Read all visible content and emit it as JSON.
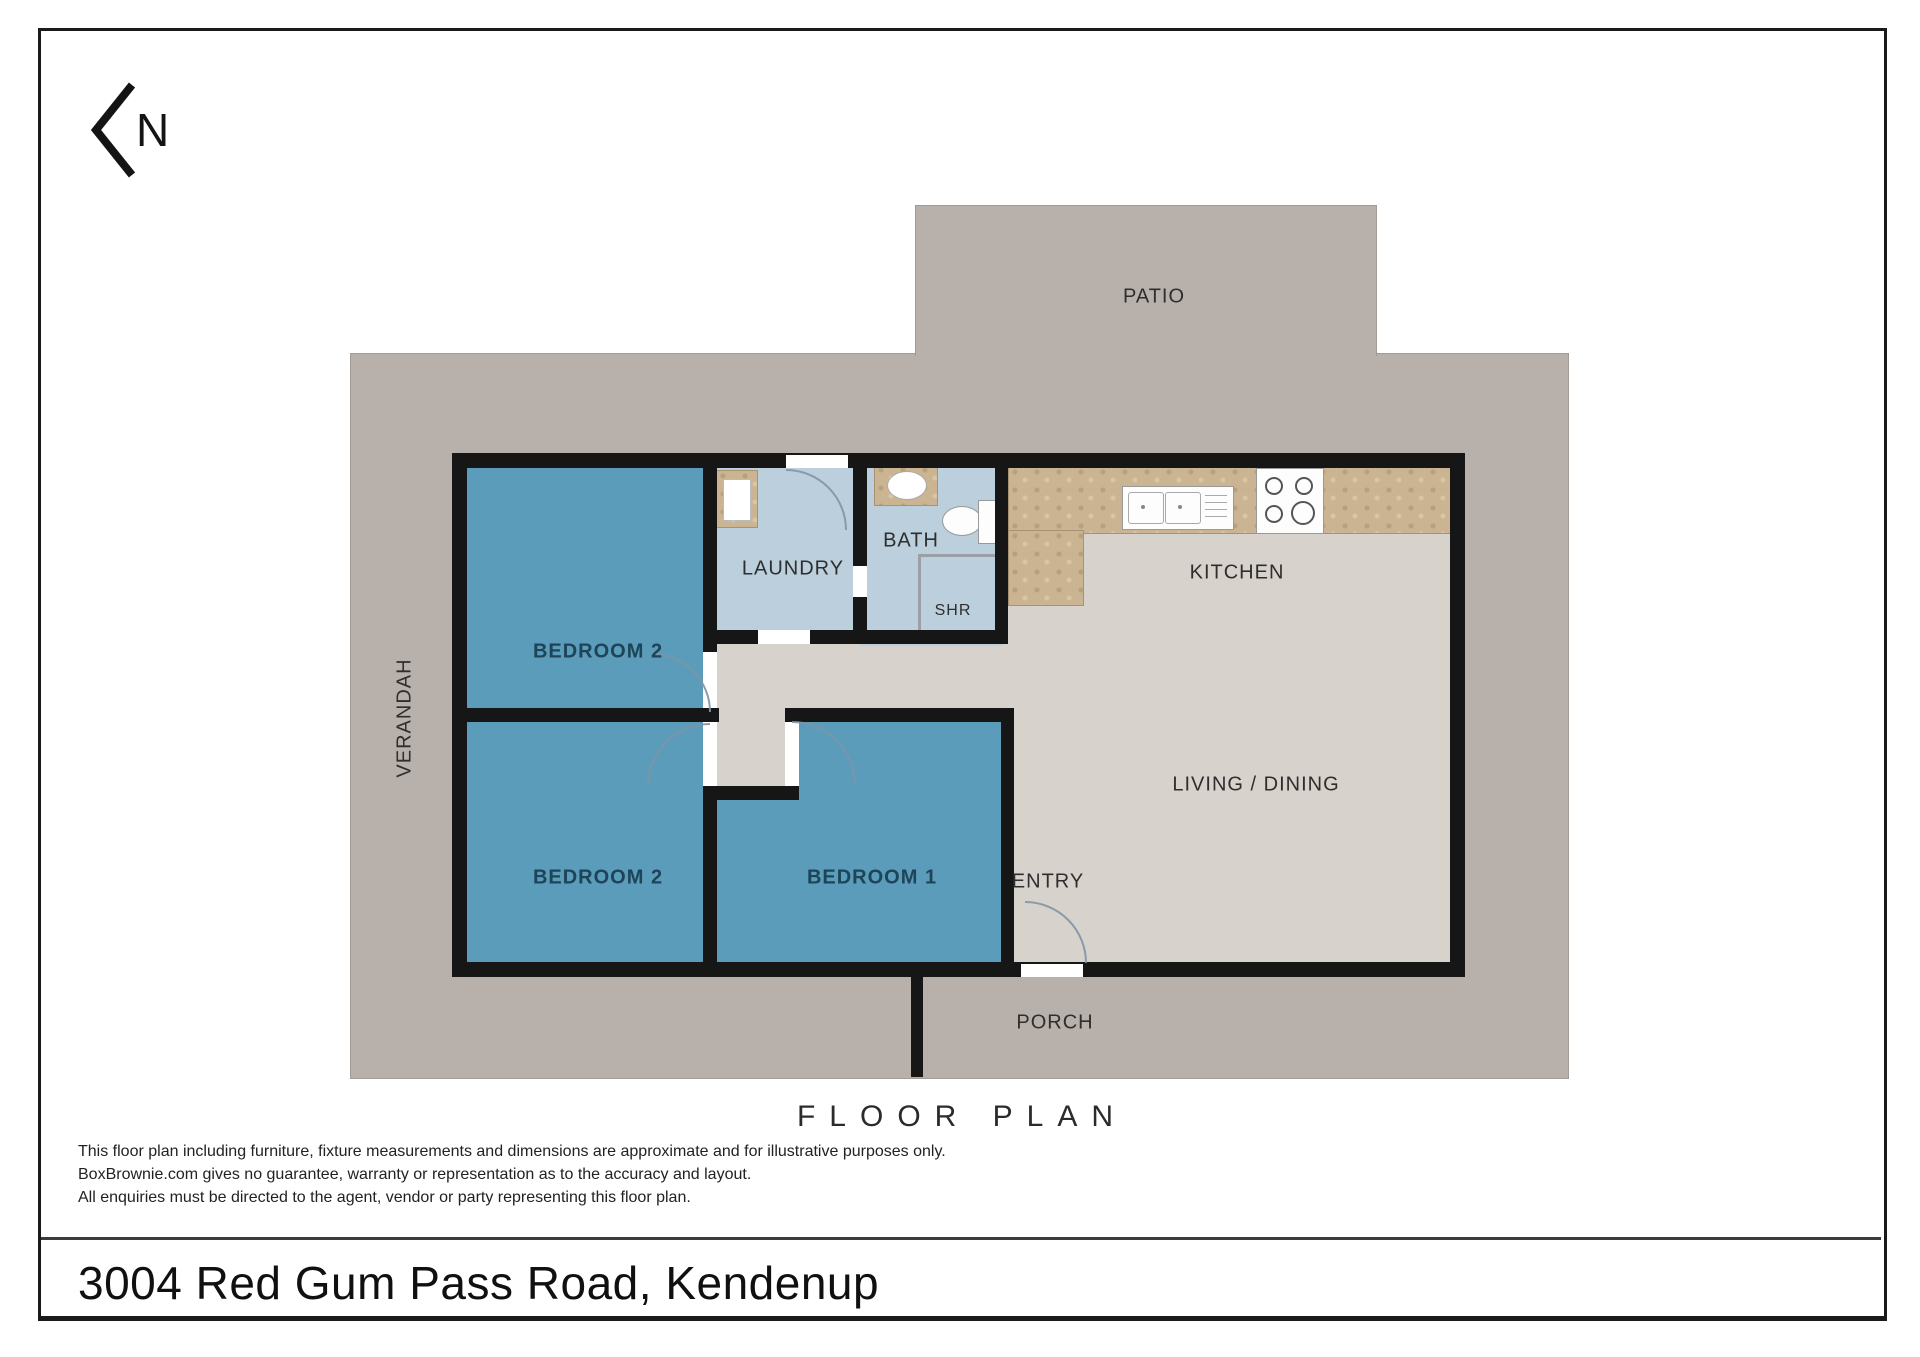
{
  "page": {
    "title": "FLOOR PLAN",
    "address": "3004 Red Gum Pass Road, Kendenup",
    "disclaimer": [
      "This floor plan including furniture, fixture measurements and dimensions are approximate and for illustrative purposes only.",
      "BoxBrownie.com gives no guarantee, warranty or representation as to the accuracy and layout.",
      "All enquiries must be directed to the agent, vendor or party representing this floor plan."
    ]
  },
  "compass": {
    "letter": "N"
  },
  "areas": {
    "patio": "PATIO",
    "verandah": "VERANDAH",
    "porch": "PORCH",
    "entry": "ENTRY"
  },
  "rooms": {
    "bedroom2_upper": "BEDROOM 2",
    "bedroom2_lower": "BEDROOM 2",
    "bedroom1": "BEDROOM 1",
    "laundry": "LAUNDRY",
    "bath": "BATH",
    "shower": "SHR",
    "kitchen": "KITCHEN",
    "living_dining": "LIVING / DINING"
  },
  "colors": {
    "slab": "#b7b0ab",
    "floor": "#d8d2cc",
    "bedroom": "#5b9cba",
    "wet_area": "#bccfdd",
    "counter": "#cbb492",
    "wall": "#161616",
    "bedroom_label": "#1d4458",
    "label": "#2e2e2e",
    "door_arc": "#7e95a6"
  },
  "icons": {
    "north_arrow": "chevron-left-with-N",
    "washing_machine": "top-view-appliance-square",
    "kitchen_sink": "double-bowl-sink-with-drainer",
    "cooktop": "four-burner-stove",
    "vanity_basin": "oval-basin-on-bench",
    "toilet": "toilet-top-view",
    "shower": "corner-shower-stall",
    "door_swing": "quarter-arc"
  }
}
